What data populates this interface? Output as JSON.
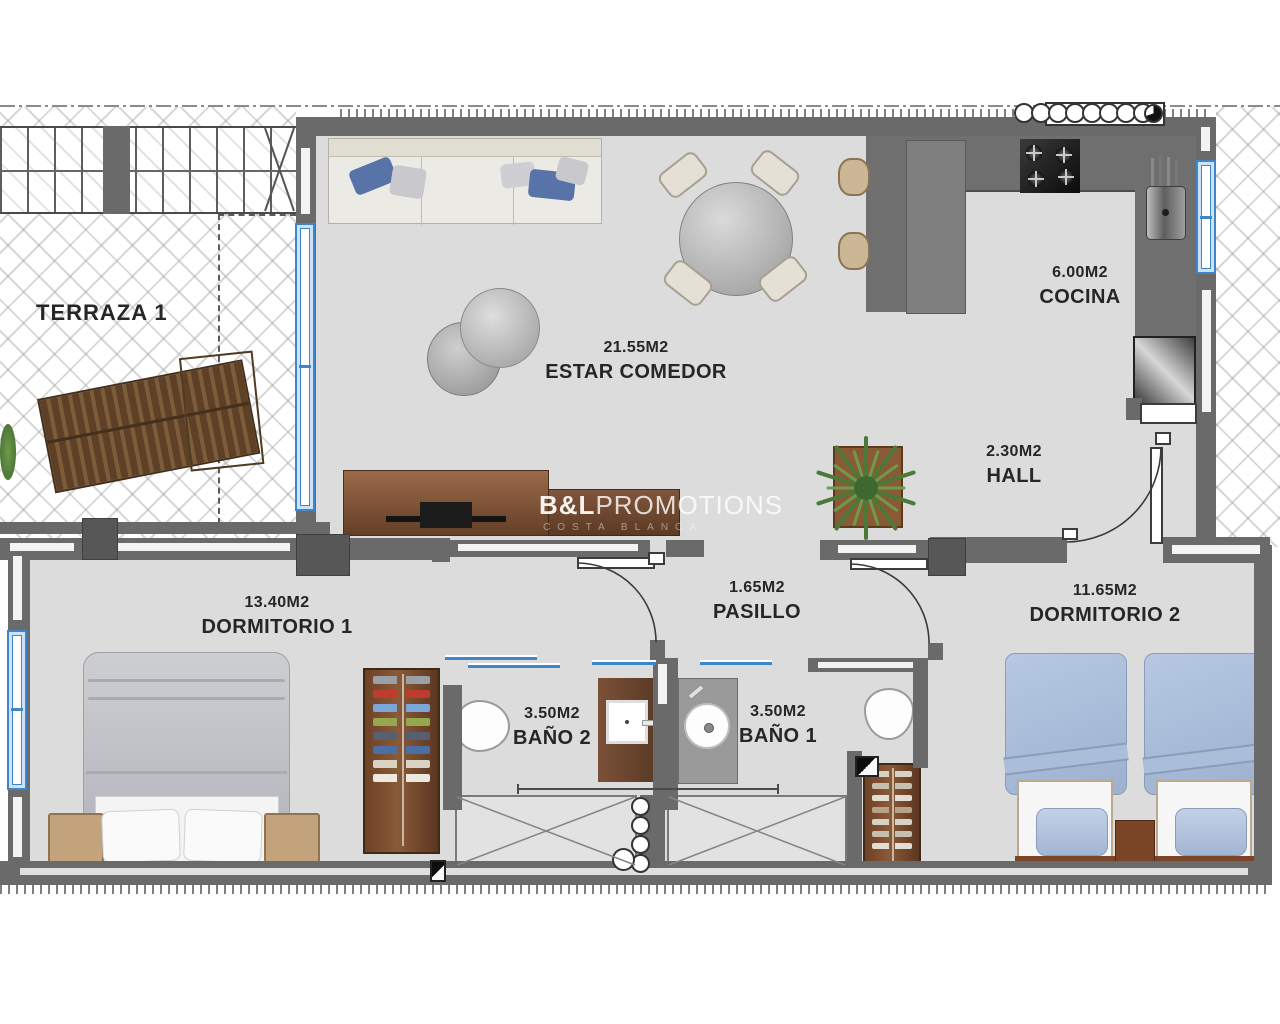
{
  "plan_type": "apartment-floor-plan",
  "watermark": {
    "brand_bold": "B&L",
    "brand_rest": "PROMOTIONS",
    "subtitle": "COSTA BLANCA"
  },
  "rooms": {
    "terraza": {
      "name": "TERRAZA 1",
      "area": ""
    },
    "estar": {
      "name": "ESTAR COMEDOR",
      "area": "21.55M2"
    },
    "cocina": {
      "name": "COCINA",
      "area": "6.00M2"
    },
    "hall": {
      "name": "HALL",
      "area": "2.30M2"
    },
    "pasillo": {
      "name": "PASILLO",
      "area": "1.65M2"
    },
    "dormitorio1": {
      "name": "DORMITORIO 1",
      "area": "13.40M2"
    },
    "dormitorio2": {
      "name": "DORMITORIO 2",
      "area": "11.65M2"
    },
    "bano1": {
      "name": "BAÑO 1",
      "area": "3.50M2"
    },
    "bano2": {
      "name": "BAÑO 2",
      "area": "3.50M2"
    }
  },
  "colors": {
    "wall": "#6a6a6a",
    "floor": "#dcdcdc",
    "window_blue": "#3f85c9",
    "wood_brown": "#7b4b2e",
    "bed2_blue": "#aabdd9",
    "label_text": "#262626"
  }
}
